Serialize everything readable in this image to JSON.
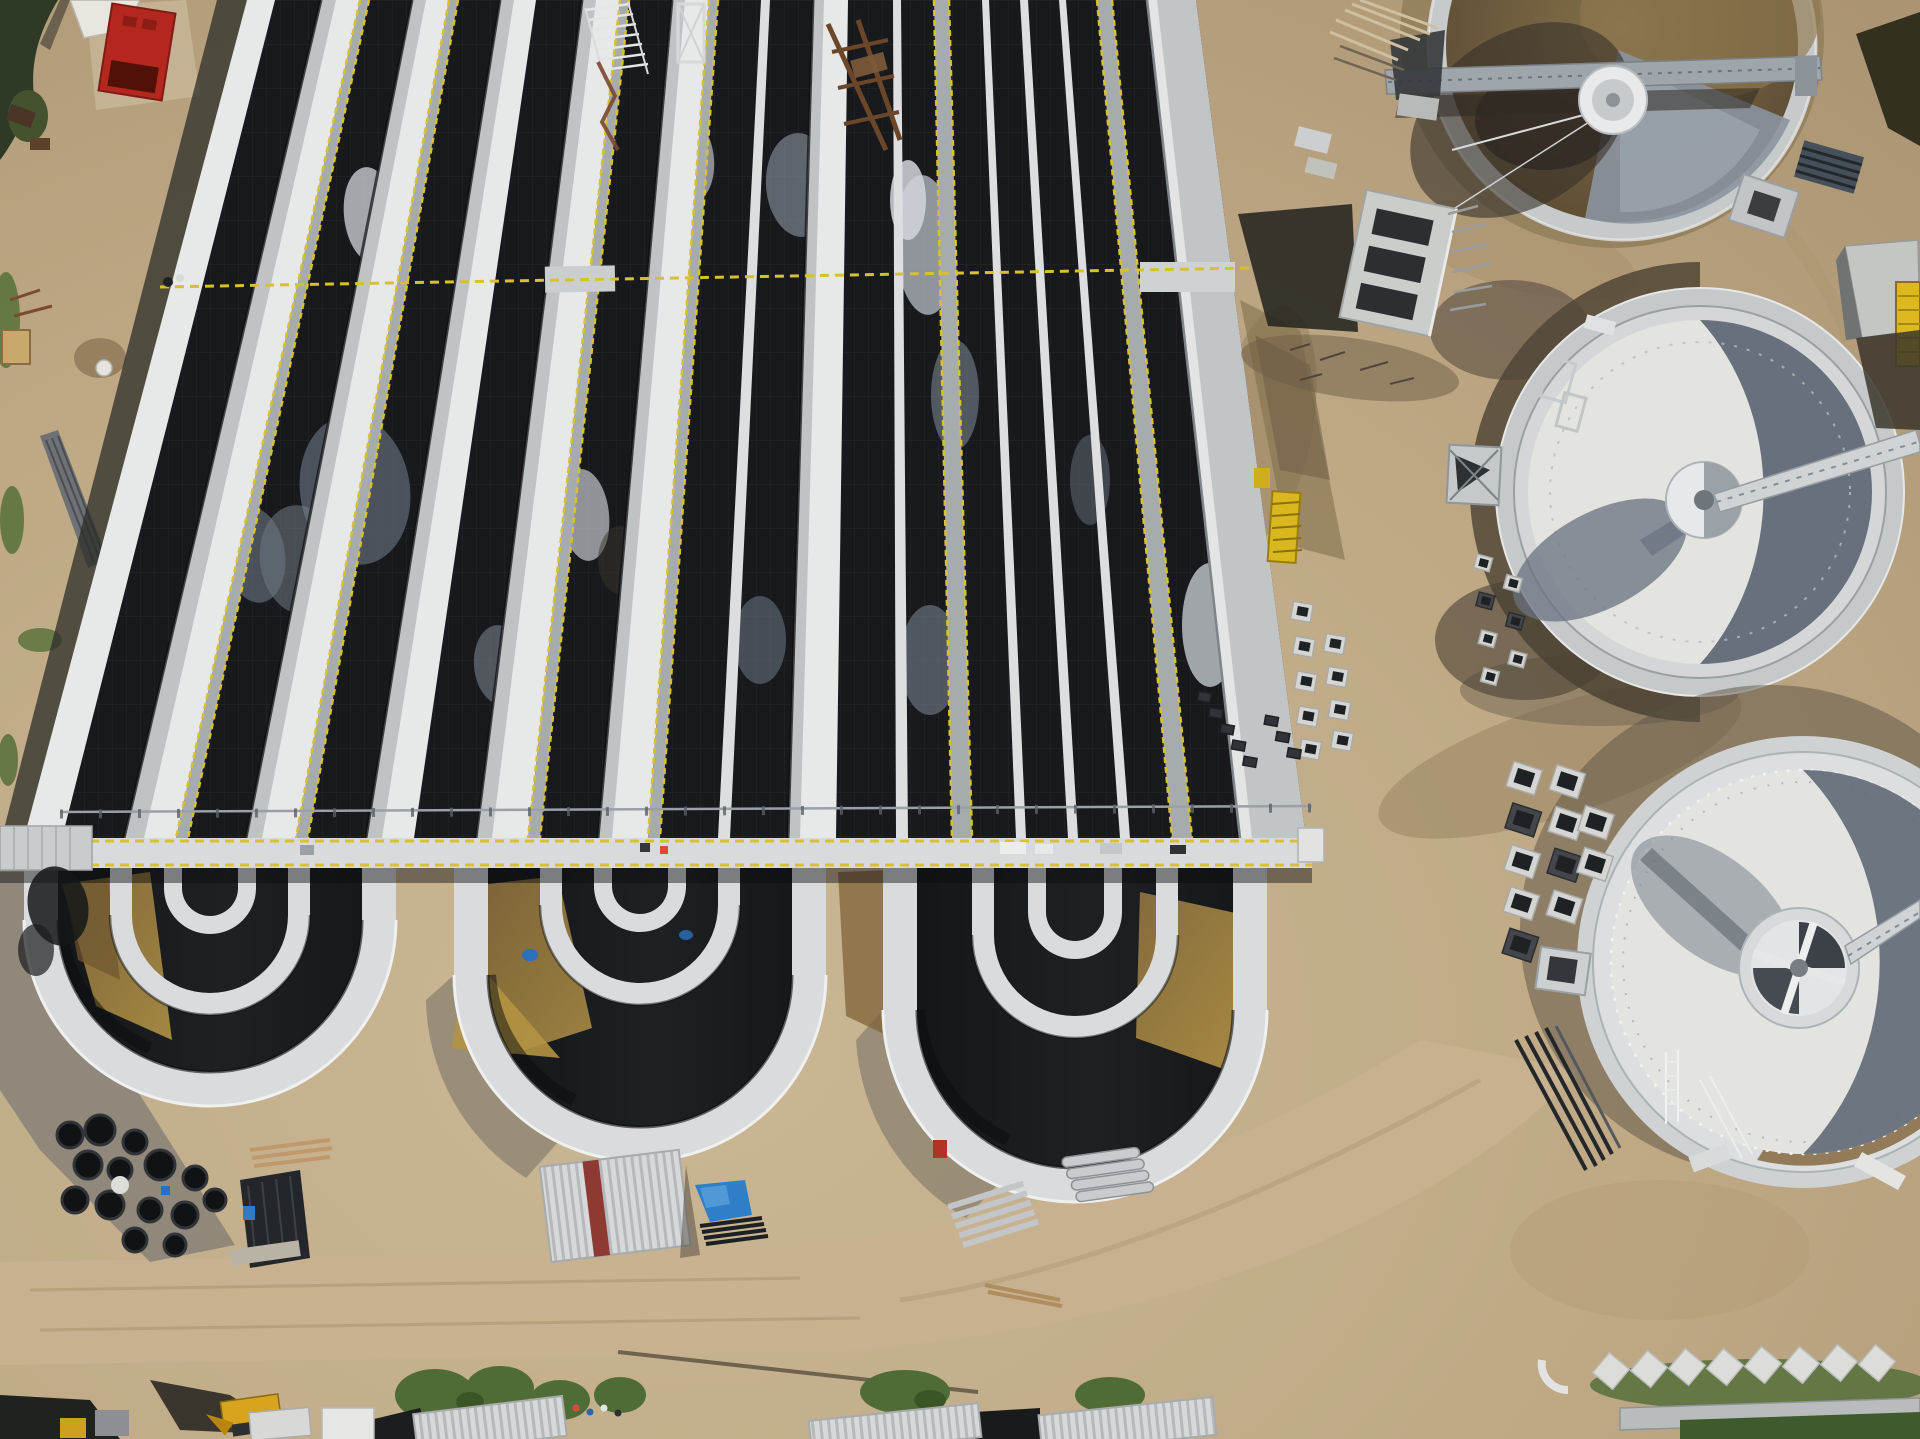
{
  "meta": {
    "title": "Aerial drone photograph of a wastewater treatment plant construction site",
    "orientation": "top-down"
  },
  "palette": {
    "dirt": "#c3ad8b",
    "dirt_light": "#cfbc9c",
    "dirt_shadow": "#8b8478",
    "water": "#17191c",
    "wall_white": "#e7e8e8",
    "wall_gray": "#c2c5c6",
    "deck": "#d8dadb",
    "railing_yellow": "#d9c02f",
    "gold_water": "#a8894f",
    "tank_floor": "#e3e4e0",
    "tank_shadow": "#5d6674",
    "tank_water_brown": "#6b5a3d",
    "drum_white": "#e8e9ea",
    "tarp_blue": "#2f7fc6",
    "container_red": "#b3271e",
    "machine_yellow": "#d8a41f",
    "grass_green": "#4f6c36",
    "truss_gray": "#9fa6ab"
  },
  "scene": {
    "site": "wastewater treatment plant under construction",
    "elements": {
      "aeration_basins": {
        "label": "Oxidation-ditch aeration basins with U-turn channels",
        "units": 3
      },
      "clarifiers": {
        "label": "Circular clarifier tanks",
        "count": 3
      },
      "walkway": {
        "label": "Concrete walkway bridge across basins"
      },
      "railings": {
        "label": "Yellow safety railings"
      },
      "distribution_chamber": {
        "label": "Concrete distribution chamber"
      },
      "materials": {
        "label": "Precast block, pipe and formwork stockpiles"
      },
      "shed": {
        "label": "Corrugated metal shed with red stripe"
      },
      "container": {
        "label": "Red site container"
      },
      "excavator": {
        "label": "Yellow excavator"
      },
      "tarp": {
        "label": "Blue tarpaulin"
      },
      "buildings": {
        "label": "Site buildings along bottom edge"
      }
    }
  }
}
